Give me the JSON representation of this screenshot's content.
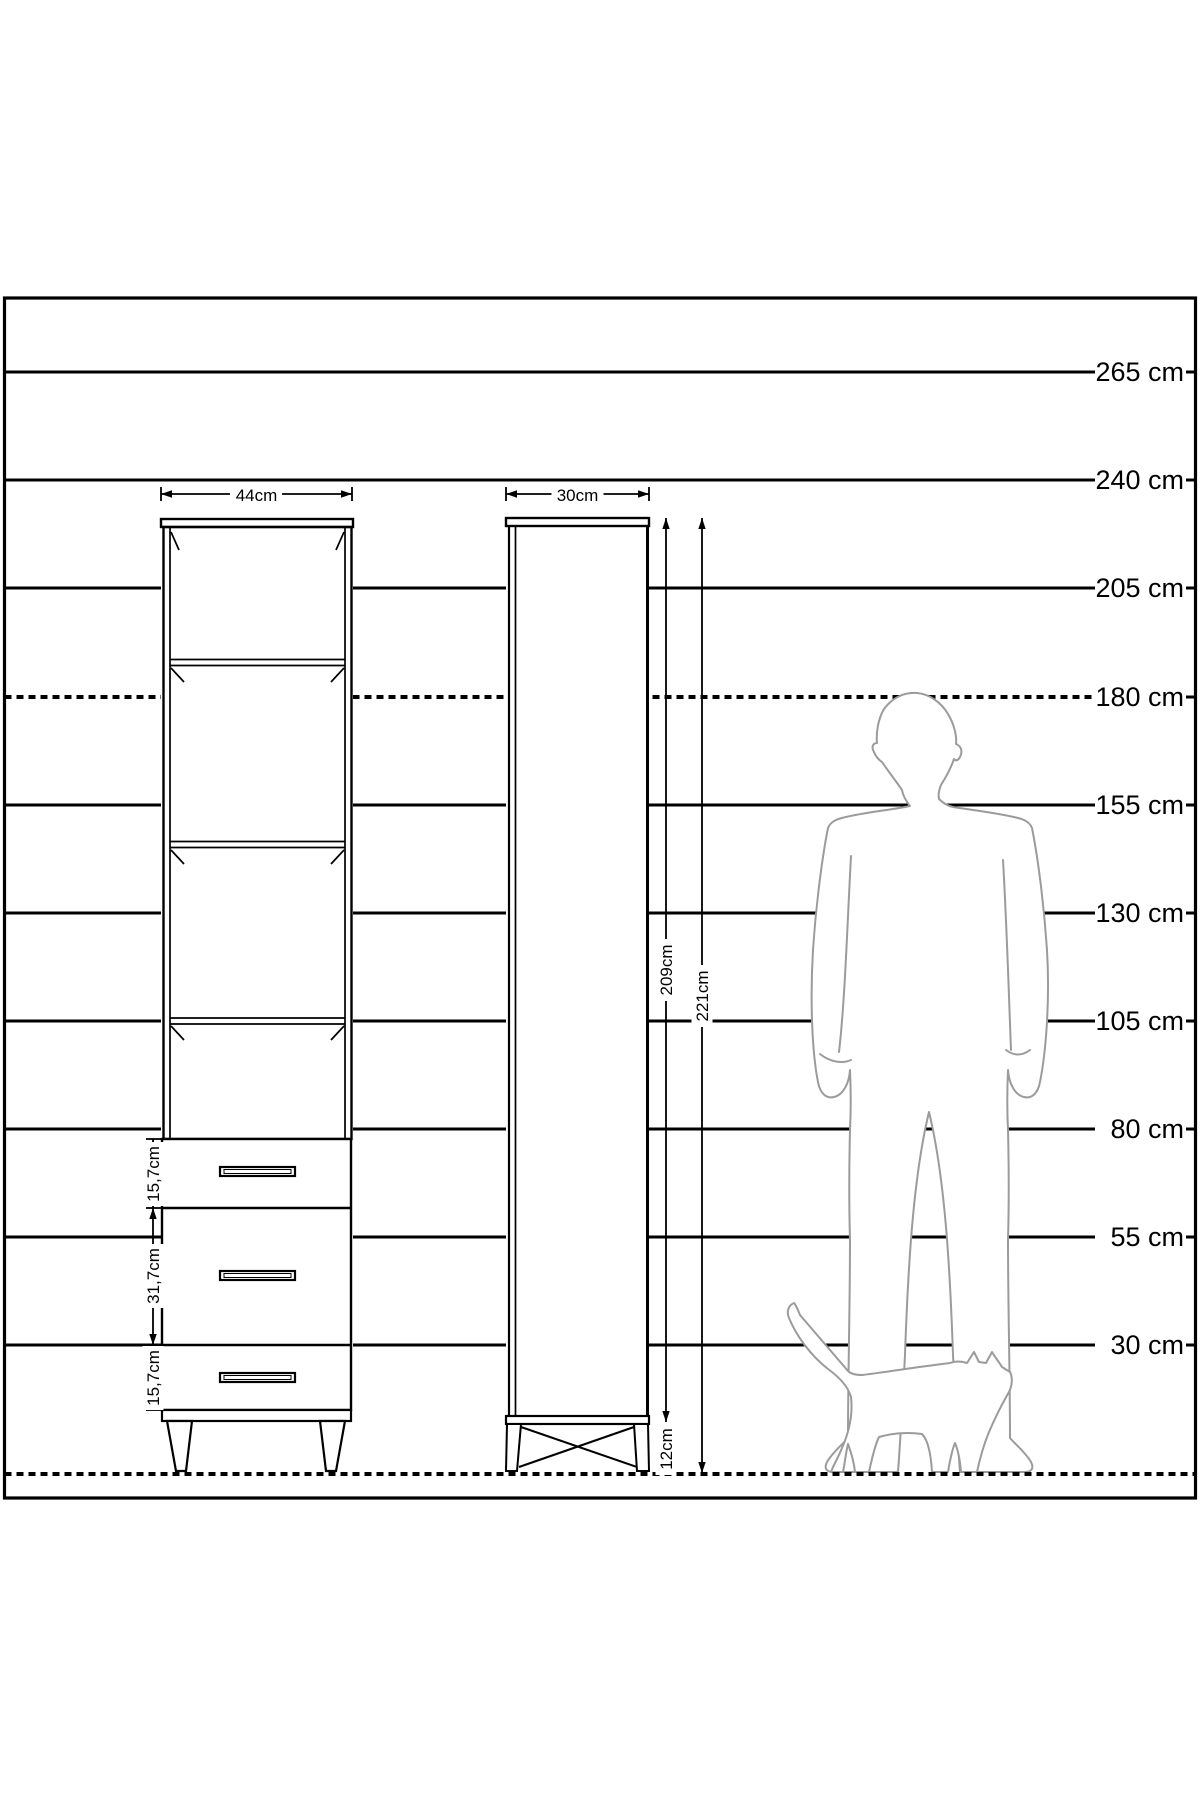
{
  "scale": {
    "unit": "cm",
    "labels": [
      "265 cm",
      "240 cm",
      "205 cm",
      "180 cm",
      "155 cm",
      "130 cm",
      "105 cm",
      "80 cm",
      "55 cm",
      "30 cm"
    ],
    "dashed_line_label": "180 cm"
  },
  "front": {
    "width_label": "44cm",
    "shelf_compartments": 4,
    "drawer_count": 3,
    "drawer_heights": [
      "15,7cm",
      "31,7cm",
      "15,7cm"
    ]
  },
  "side": {
    "depth_label": "30cm",
    "carcass_height_label": "209cm",
    "total_height_label": "221cm",
    "leg_height_label": "12cm"
  },
  "figures": {
    "man": "adult-man-silhouette",
    "cat": "cat-silhouette"
  },
  "colors": {
    "ink": "#000000",
    "silhouette_outline": "#9b9b9b",
    "background": "#ffffff"
  }
}
